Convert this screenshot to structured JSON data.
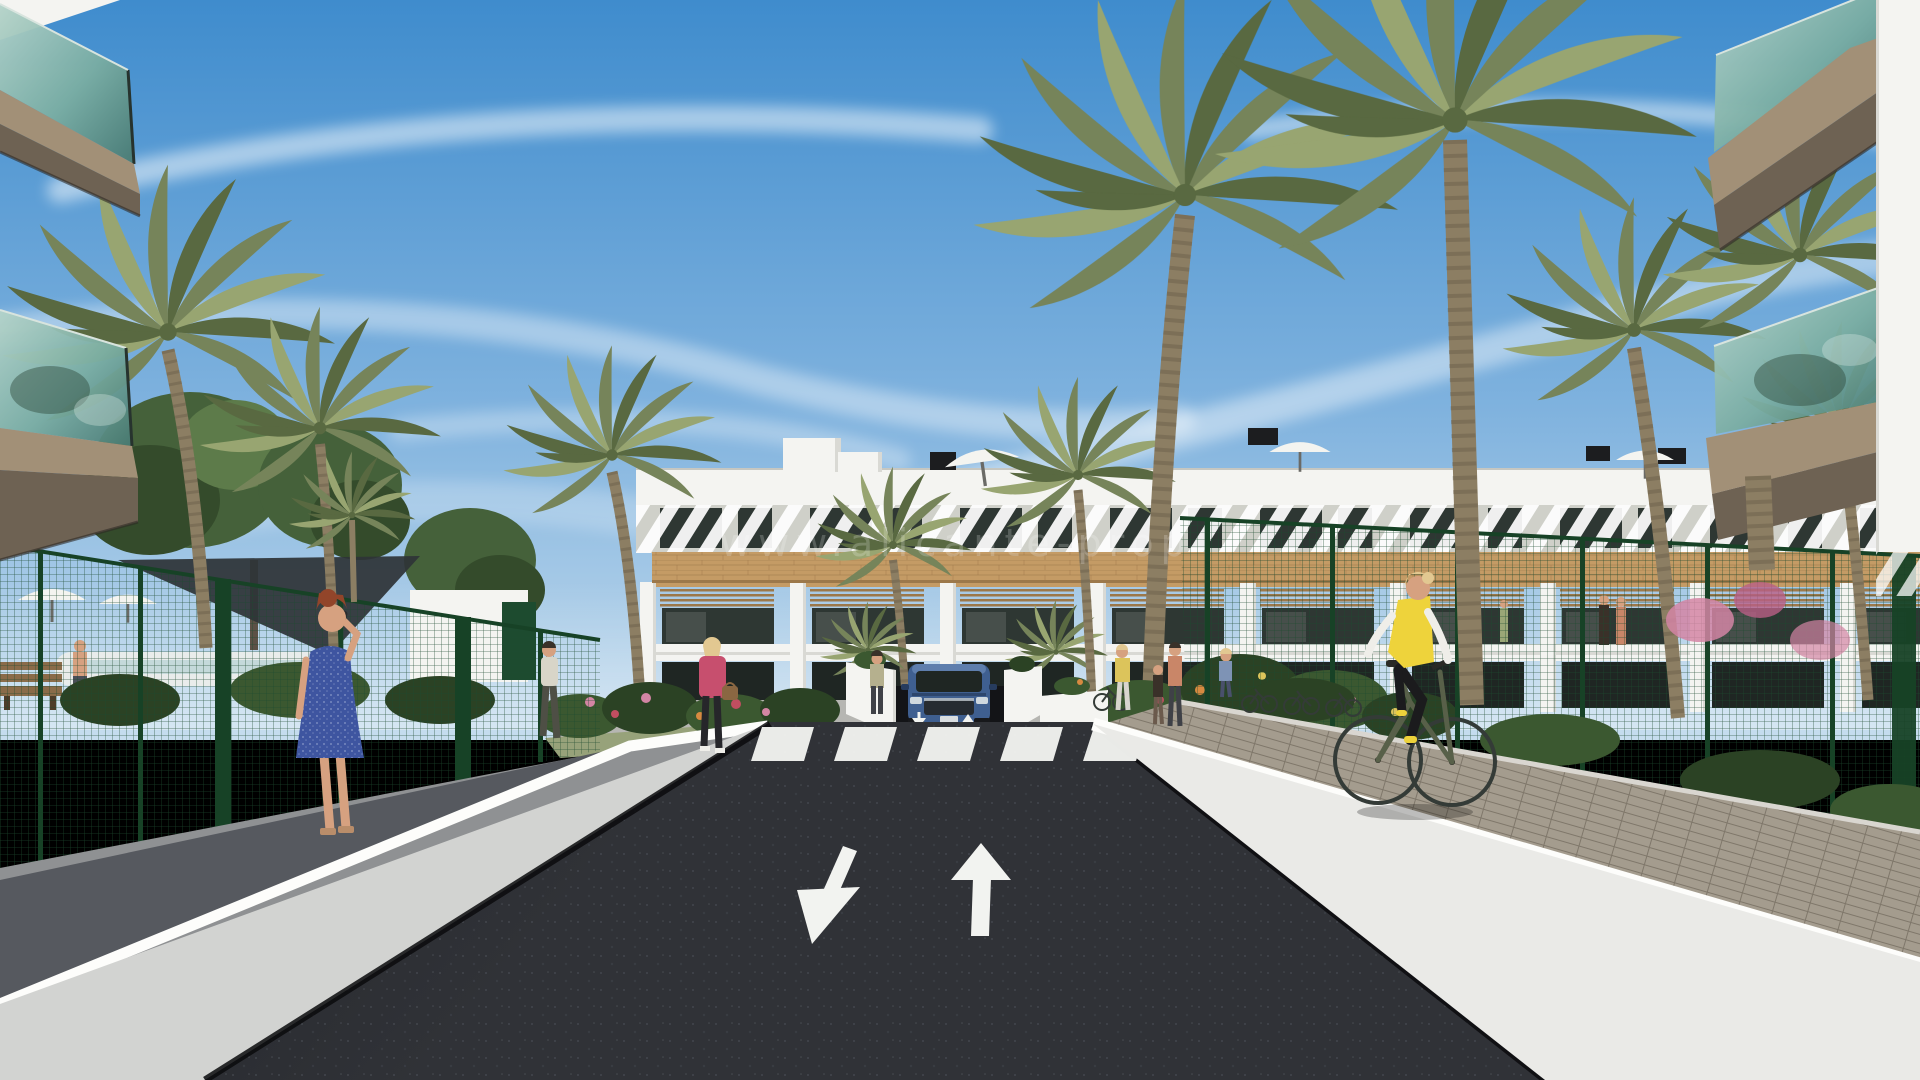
{
  "meta": {
    "kind": "3D architectural render",
    "subject": "street view of a new-build Mediterranean apartment complex with palm trees",
    "canvas": {
      "width": 1920,
      "height": 1080
    }
  },
  "watermark": {
    "text": "www.alicante-prop"
  },
  "scene": {
    "sky": "blue sky with wispy cirrus cloud streaks",
    "building": {
      "floors": 3,
      "style": "white facade, timber-clad band, pergola terraces, rooftop solariums",
      "rooftop_items": [
        "stair towers",
        "black chimneys",
        "white parasols"
      ]
    },
    "road": {
      "surface": "dark asphalt",
      "lane_arrows": [
        {
          "direction": "down-left"
        },
        {
          "direction": "up"
        }
      ],
      "crosswalk_stripes": 5,
      "ramp_arrows": 2
    },
    "vehicles": [
      {
        "type": "suv",
        "color": "blue",
        "location": "underground parking ramp"
      }
    ],
    "people": [
      {
        "id": "woman-blue-dress",
        "desc": "red-haired woman in blue dress on phone, left walkway"
      },
      {
        "id": "woman-pink-jacket",
        "desc": "blonde woman in pink jacket with handbag near crosswalk"
      },
      {
        "id": "man-walking",
        "desc": "man in white t-shirt on garden path"
      },
      {
        "id": "man-poolside",
        "desc": "shirtless man beside pool behind left fence"
      },
      {
        "id": "woman-by-wall",
        "desc": "woman standing at planter wall left of ramp"
      },
      {
        "id": "pedestrian-group",
        "desc": "women and child near bike racks right of ramp"
      },
      {
        "id": "cyclist",
        "desc": "blonde woman in yellow vest cycling on right path"
      },
      {
        "id": "terrace-couple",
        "desc": "small figures on a first-floor terrace"
      }
    ],
    "amenities": [
      "white parasols",
      "dark shade sail",
      "pool edge",
      "wooden bench",
      "bike racks",
      "green mesh fences",
      "glass balconies"
    ],
    "vegetation": [
      "tall palm trees",
      "deciduous trees",
      "flowering shrubs in pink, red and orange"
    ]
  },
  "colors": {
    "sky_top": "#3f8ccd",
    "sky_mid": "#7fb2de",
    "sky_low": "#c6ddee",
    "cloud": "#ffffff",
    "facade": "#f4f4f1",
    "facade_shade": "#d9d9d4",
    "roof_edge": "#c6c7c1",
    "stripe_base": "#cfd0c9",
    "wood": "#c49b65",
    "wood_dark": "#9c784a",
    "window_glass": "#2e3733",
    "window_deep": "#1f2623",
    "tunnel": "#131417",
    "glass_light": "#b4d3c9",
    "glass_mid": "#7aada2",
    "glass_dark": "#487971",
    "slab": "#a29077",
    "slab_dark": "#6e6253",
    "fence_mesh": "#1d4b2f",
    "fence_post": "#174226",
    "palm": "#76845a",
    "palm_dark": "#596941",
    "palm_light": "#98a571",
    "trunk": "#8c7e63",
    "trunk_dark": "#695d4a",
    "tree": "#45613a",
    "tree_dark": "#344b2b",
    "tree_light": "#5d7b4a",
    "road": "#222429",
    "road_light": "#303237",
    "marking": "#f2f3f0",
    "wall_left": "#d2d3d1",
    "wall_right": "#eaeae7",
    "wall_bright": "#fdfdfb",
    "path_gray": "#8f9193",
    "pavers_dark": "#50535a",
    "paver": "#a49c8e",
    "paver_line": "#7f776a",
    "concrete": "#b6b6b2",
    "grass": "#97a27a",
    "shrub": "#3b5830",
    "shrub_dark": "#2b4224",
    "flower_pink": "#d385a4",
    "flower_red": "#c04e60",
    "flower_orange": "#d78a40",
    "flower_yellow": "#dcc45b",
    "skin": "#d6a180",
    "car_blue": "#3f5f90",
    "car_blue_dark": "#273c5e",
    "car_blue_light": "#5e7ead",
    "vest_yellow": "#eed33b",
    "dress_blue": "#3e55a0",
    "jacket_pink": "#c74f6e",
    "hair_red": "#92452a",
    "hair_blonde": "#e2c891",
    "hair_dark": "#3a3129",
    "sail": "#2e3437",
    "umbrella": "#f4f4f0",
    "pool_edge": "#e9eceb",
    "bench": "#8a6b49",
    "bike_metal": "#343b37",
    "bike_frame": "#586049",
    "figure_coral": "#c98668"
  }
}
